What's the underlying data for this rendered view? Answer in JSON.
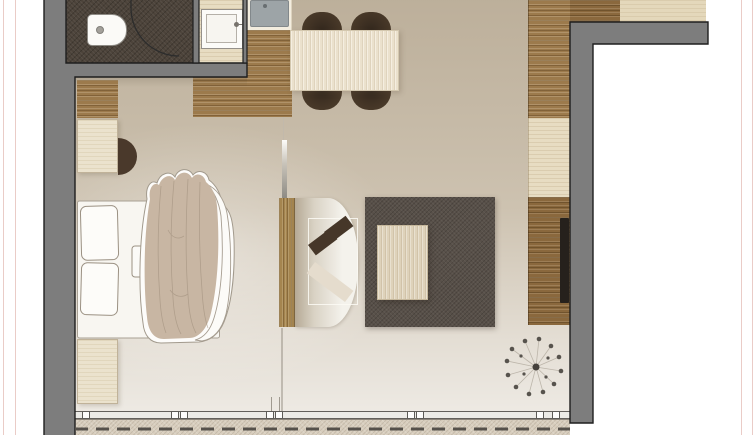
{
  "meta": {
    "title": "Studio apartment floor plan",
    "type": "architectural floor plan, top-down view, no visible text in image"
  },
  "palette": {
    "page_background": "#ffffff",
    "guide_line_pink": "#eaccc7",
    "wall_fill": "#7d7d7d",
    "wall_outline": "#1e1e1e",
    "bathroom_floor": "#4c433a",
    "wood_medium": "#9c7a4c",
    "wood_dark": "#8a683d",
    "wood_cream": "#ebe2cd",
    "floor_tan": "#cdc2b0",
    "floor_light": "#f2efe9",
    "rug_dark": "#585049",
    "chair_brown": "#443526",
    "sofa_seat": "#f4f2ec",
    "cushion_dark": "#463729",
    "cushion_light": "#e5dccd",
    "duvet_beige": "#c8b6a3",
    "sink_gray": "#9da4a7",
    "tv_black": "#26211c",
    "balcony_band": "#d8cebe"
  },
  "rooms": {
    "bathroom": {
      "label": "Bathroom"
    },
    "washbasin_room": {
      "label": "Washbasin room"
    },
    "kitchenette": {
      "label": "Kitchenette"
    },
    "living_sleeping": {
      "label": "Living and sleeping area"
    },
    "balcony": {
      "label": "Balcony / terrace"
    },
    "exterior": {
      "label": "Outside"
    }
  },
  "fixtures": {
    "toilet": {
      "label": "Toilet"
    },
    "washbasin": {
      "label": "Washbasin"
    },
    "kitchen_sink": {
      "label": "Kitchen sink"
    },
    "bathroom_door": {
      "label": "Bathroom door (swing arc)"
    },
    "window_front": {
      "label": "Full-width window front"
    },
    "room_divider": {
      "label": "Room divider panel"
    },
    "walls": {
      "label": "Walls"
    }
  },
  "furniture": {
    "dining_table": {
      "label": "Dining table",
      "seats": 4
    },
    "dining_chair": {
      "label": "Dining chair"
    },
    "kitchen_counter": {
      "label": "Kitchen counter"
    },
    "entry_wood_floor": {
      "label": "Entry parquet floor"
    },
    "wardrobe_left": {
      "label": "Wardrobe cabinet"
    },
    "desk": {
      "label": "Desk / vanity"
    },
    "desk_chair": {
      "label": "Desk chair"
    },
    "bed": {
      "label": "Double bed"
    },
    "pillow_1": {
      "label": "Pillow"
    },
    "pillow_2": {
      "label": "Pillow"
    },
    "duvet": {
      "label": "Duvet"
    },
    "bed_tray": {
      "label": "Bedside tray"
    },
    "bench": {
      "label": "Dresser at bed foot"
    },
    "sofa": {
      "label": "Sofa"
    },
    "cushions": {
      "label": "Throw cushions"
    },
    "coffee_table": {
      "label": "Coffee table"
    },
    "rug": {
      "label": "Rug"
    },
    "sideboard": {
      "label": "TV sideboard"
    },
    "tv": {
      "label": "Wall-mounted TV"
    },
    "wardrobe_right": {
      "label": "Wardrobe along right wall"
    },
    "hall_cabinet": {
      "label": "Hall cabinet"
    },
    "plant": {
      "label": "Potted plant"
    }
  }
}
